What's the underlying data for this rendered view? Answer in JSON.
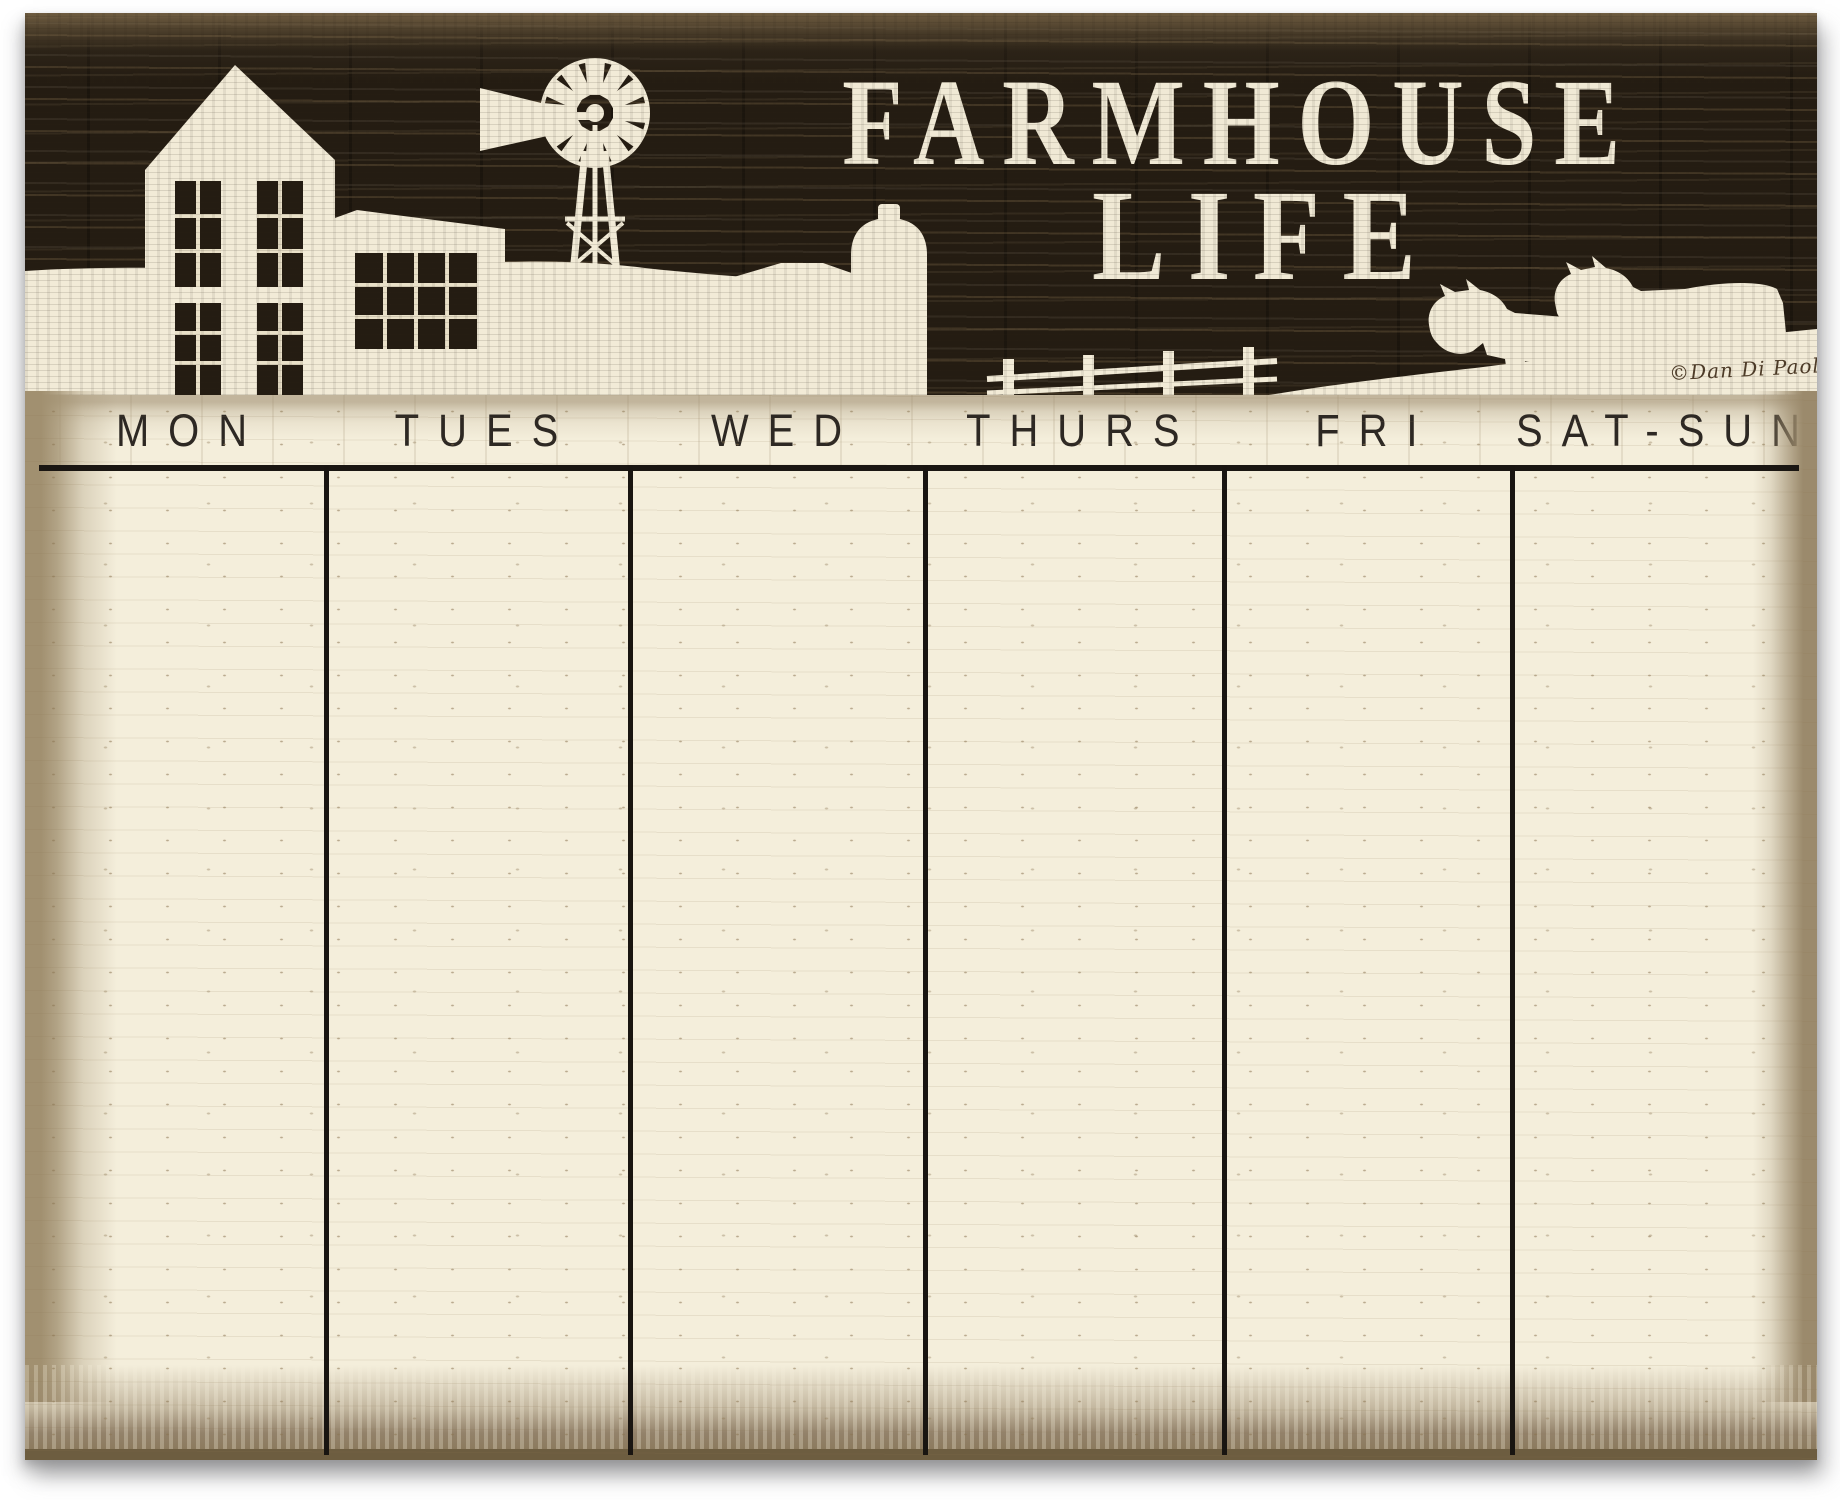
{
  "board": {
    "title_line1": "FARMHOUSE",
    "title_line2": "LIFE",
    "signature": "©Dan Di Paolo",
    "colors": {
      "wood_dark": "#241c12",
      "cream": "#f4eedb",
      "silhouette_cream": "#f2ebd7",
      "tan_border": "#9b8a6c",
      "grid_ink": "#1a1612",
      "day_text": "#2d2823",
      "title_text": "#f0e9d5",
      "signature_ink": "#4e3c28"
    }
  },
  "calendar": {
    "days": [
      {
        "label": "MON"
      },
      {
        "label": "TUES"
      },
      {
        "label": "WED"
      },
      {
        "label": "THURS"
      },
      {
        "label": "FRI"
      },
      {
        "label": "SAT-SUN"
      }
    ]
  }
}
